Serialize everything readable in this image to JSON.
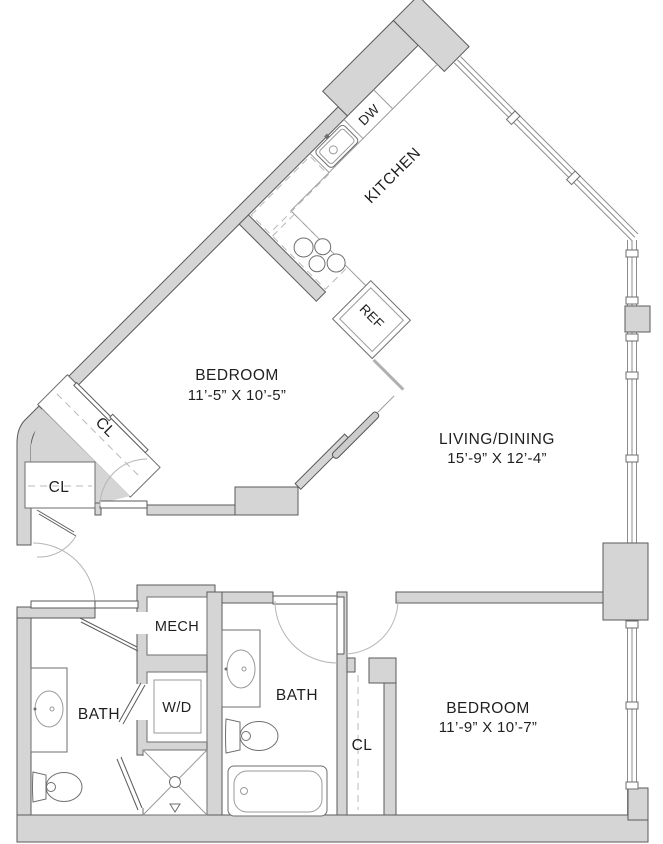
{
  "plan": {
    "title": "apartment-floor-plan",
    "rooms": {
      "kitchen": {
        "label": "KITCHEN"
      },
      "bedroom1": {
        "label": "BEDROOM",
        "dims": "11’-5” X 10’-5”"
      },
      "living": {
        "label": "LIVING/DINING",
        "dims": "15’-9” X 12’-4”"
      },
      "bedroom2": {
        "label": "BEDROOM",
        "dims": "11’-9” X 10’-7”"
      },
      "bath1": {
        "label": "BATH"
      },
      "bath2": {
        "label": "BATH"
      },
      "mech": {
        "label": "MECH"
      },
      "laundry": {
        "label": "W/D"
      },
      "closet_bedroom1": {
        "label": "CL"
      },
      "closet_entry": {
        "label": "CL"
      },
      "closet_bedroom2": {
        "label": "CL"
      }
    },
    "appliances": {
      "dishwasher": "DW",
      "refrigerator": "REF"
    },
    "colors": {
      "wall_fill": "#d5d5d5",
      "wall_stroke": "#5a5a5a",
      "fixture_line": "#6e6e6e",
      "glass_line": "#8c8c8c",
      "text": "#1f1f1f",
      "background": "#ffffff"
    }
  }
}
